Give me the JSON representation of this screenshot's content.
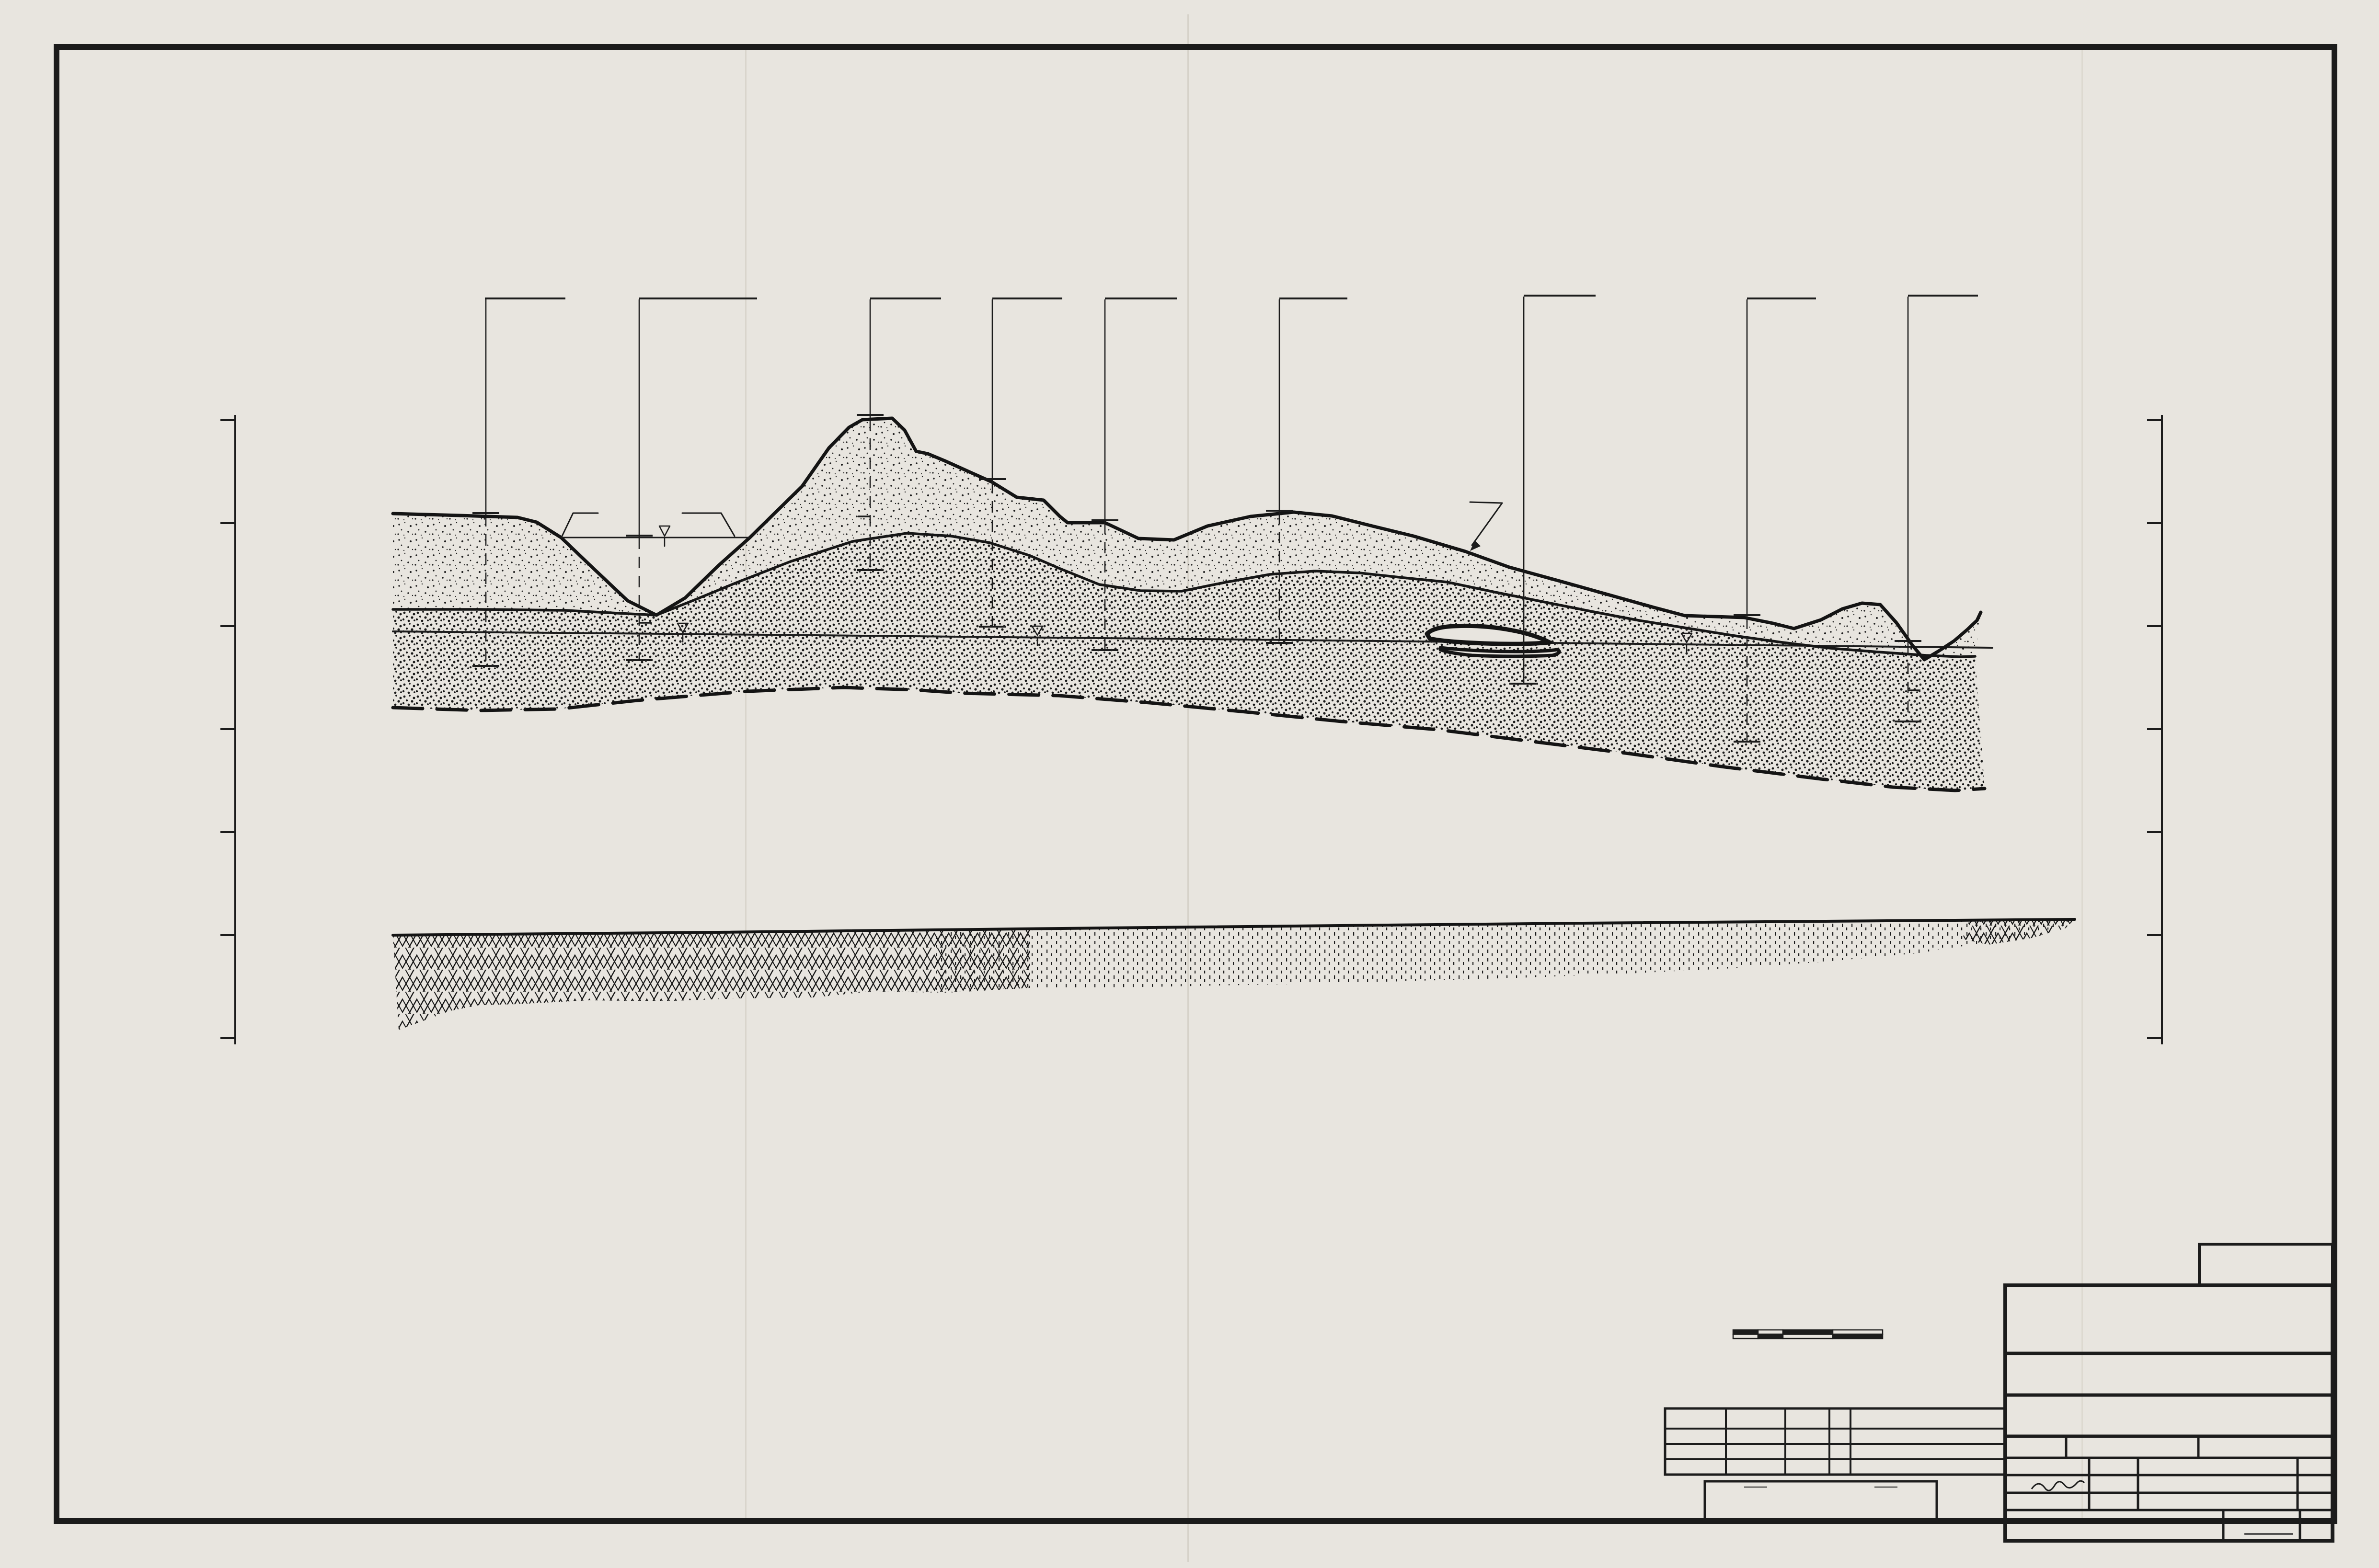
{
  "page": {
    "date": "October, 1981",
    "page_number": "-42-",
    "doc_number": "786085",
    "margin_marks": [
      "J",
      "W",
      "M"
    ]
  },
  "axis": {
    "title": "ELEVATION (METERS), MSL",
    "ticks": [
      "520",
      "500",
      "480",
      "460",
      "440",
      "420",
      "400"
    ]
  },
  "boreholes": [
    {
      "label": "G40-M14"
    },
    {
      "label": "DMA-1,DMB-15"
    },
    {
      "label": "G40-P17"
    },
    {
      "label": "DMB-16"
    },
    {
      "label": "G40-P20"
    },
    {
      "label": "DMB-11"
    },
    {
      "label": "G40-R23",
      "sublabel": "℄ OF SECTION LINE"
    },
    {
      "label": "DMB-12"
    },
    {
      "label": "DMA-17"
    }
  ],
  "annotations": {
    "lake": "OAK  LAKE",
    "ground_surface": "APPROXIMATE  GROUND  SURFACE"
  },
  "note": {
    "heading": "NOTE",
    "lines": [
      "SEE GEOLOGIC PROFILES SECTION A-A  DRAWING NO. 050-1-80911,",
      "FOR  LEGEND  AND  GENERAL  NOTES."
    ]
  },
  "scale_bar": {
    "tick_labels": [
      "0",
      "50",
      "100",
      "200",
      "300"
    ],
    "caption_line1": "HORIZONTAL  SCALE  IN  METERS",
    "caption_line2": "VERTICAL  EXAGERATION :   10 x"
  },
  "revision_table": {
    "headers": [
      "REVISED",
      "DATE",
      "BY",
      "DESCRIPTION"
    ]
  },
  "proprietary": {
    "heading": "EXXON PROPRIETARY",
    "lines": [
      "This document contains proprietary information of Exxon Minerals Company",
      "U.S.A. and is not to be reproduced in whole or in part, made available to others, or used",
      "for any unauthorized purpose without the prior written consent of Exxon Minerals",
      "Company, U.S.A. It is to be returned upon completion of the work for which it has been",
      "made available or on request of Exxon Minerals Company U.S.A. prior to the comple-",
      "tion of such work."
    ]
  },
  "title_block": {
    "figure": "FIGURE  3.18",
    "firm": "Golder  Associates",
    "firm_location": "Atlanta , Georgia",
    "client": "EXXON MINERALS COMPANY, U.S.A.",
    "project": "CRANDON PROJECT",
    "labels": {
      "title": "TITLE",
      "scale": "SCALE",
      "state": "STATE",
      "county": "COUNTY",
      "drawn": "DRAWN BY",
      "date": "DATE",
      "checked": "CHECKED BY",
      "approved": "APPROVED BY",
      "exxon": "EXXON",
      "drawing_no": "DRAWING NO.",
      "sheet": "SHEET",
      "of": "OF",
      "revision": "REVISION NO."
    },
    "values": {
      "title_line1": "GEOLOGIC  PROFILES",
      "title_line2": "SECTION  G-G",
      "scale": "AS SHOWN",
      "state": "WISCONSIN",
      "county": "FOREST , LANGLADE",
      "drawn": "CAB",
      "drawn_date": "9-16-81",
      "checked": "JVK",
      "checked_date": "10-9-81",
      "approved_date": "10-9-81",
      "drawing_no": "050-1-80918"
    }
  }
}
